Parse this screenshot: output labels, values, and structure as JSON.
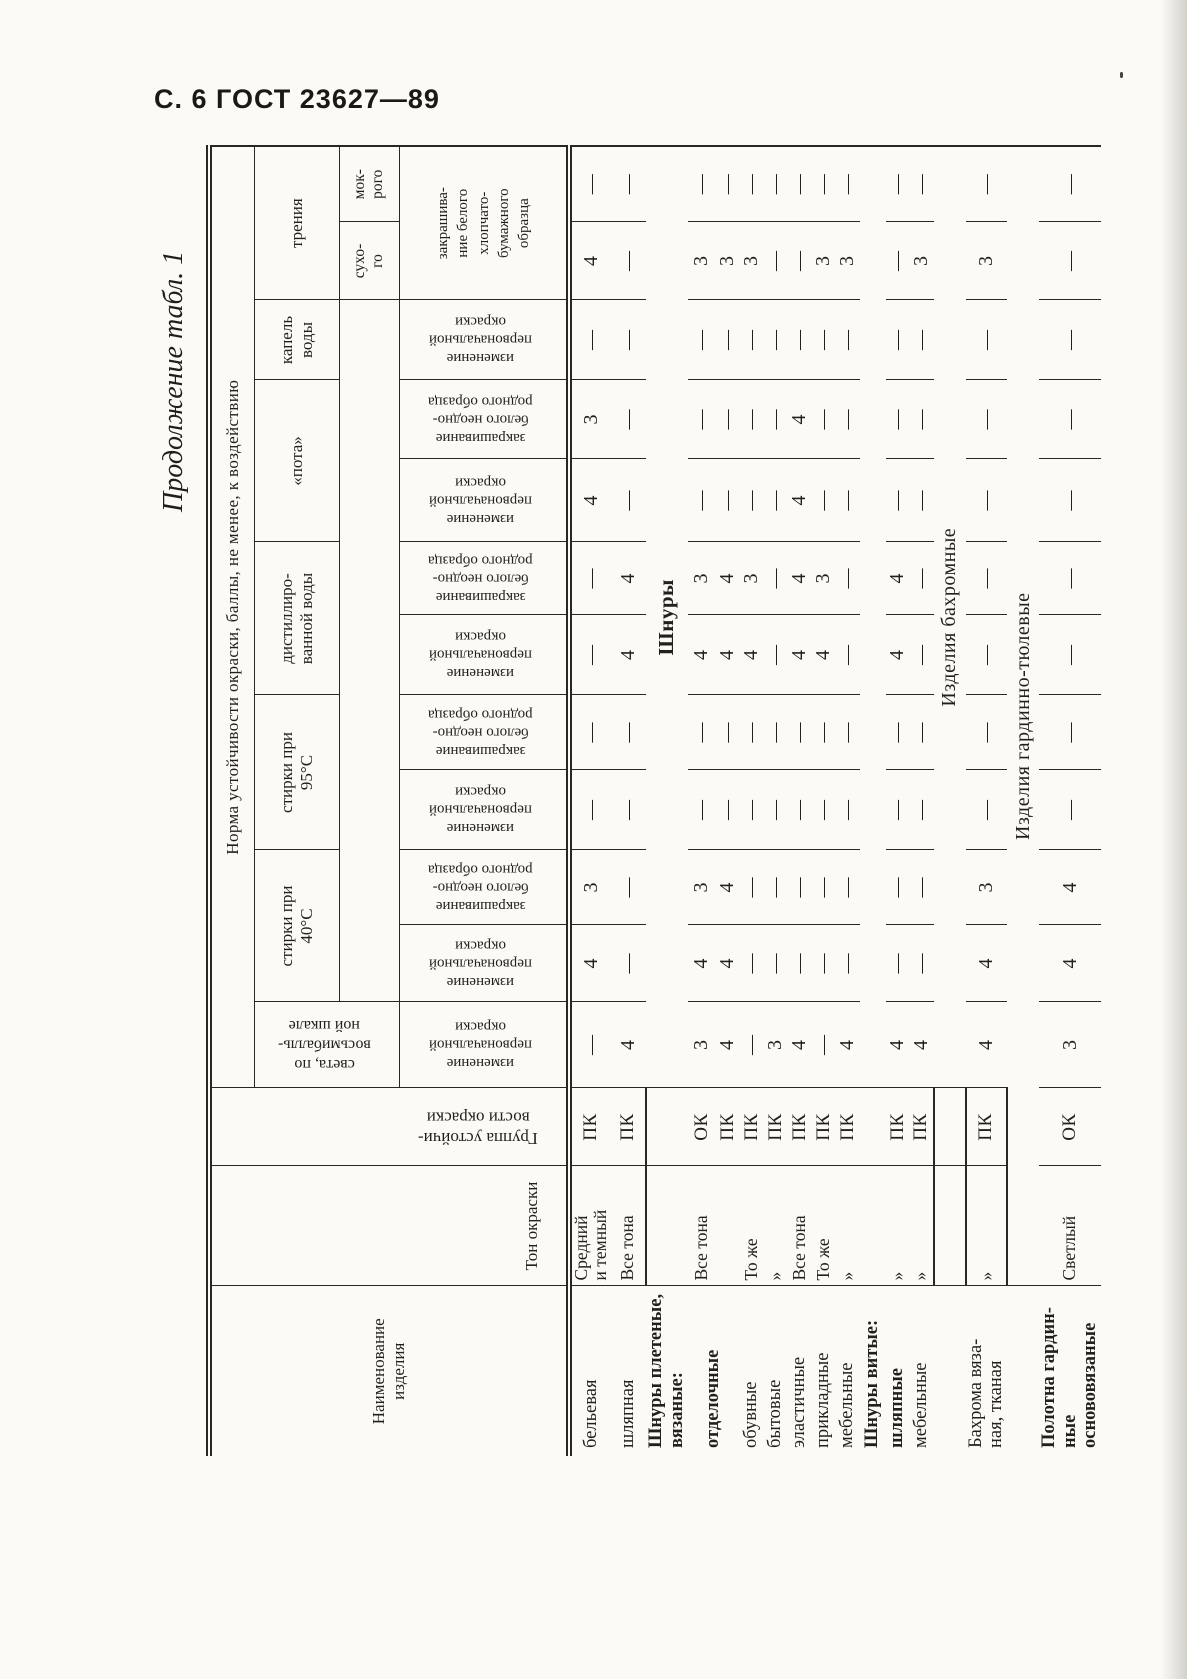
{
  "page": {
    "header": "С. 6 ГОСТ 23627—89",
    "continuation": "Продолжение табл. 1"
  },
  "colors": {
    "ink": "#241f19",
    "paper": "#fbfaf6",
    "rule": "#2b2620"
  },
  "table": {
    "header": {
      "name": "Наименование\nизделия",
      "tone": "Тон окраски",
      "group": "Группа устойчи-\nвости окраски",
      "norm": "Норма  устойчивости  окраски,  баллы,  не  менее,  к  воздействию",
      "scale5": "по пятибалльной шкале",
      "light": "света, по\nвосьмибалль-\nной шкале",
      "wash40": "стирки при\n40°С",
      "wash95": "стирки при\n95°С",
      "dist": "дистиллиро-\nванной воды",
      "sweat": "«пота»",
      "drops": "капель\nводы",
      "friction": "трения",
      "dry": "сухо-\nго",
      "wet": "мок-\nрого",
      "change": "изменение\nпервоначальной\nокраски",
      "stain": "закрашивание\nбелого неодно-\nродного образца",
      "stain_cotton": "закрашива-\nние белого\nхлопчато-\nбумажного\nобразца"
    },
    "value_columns": [
      "света — изменение первоначальной окраски",
      "стирки при 40°С — изменение",
      "стирки при 40°С — закрашивание",
      "стирки при 95°С — изменение",
      "стирки при 95°С — закрашивание",
      "дистиллированной воды — изменение",
      "дистиллированной воды — закрашивание",
      "«пота» — изменение",
      "«пота» — закрашивание",
      "капель воды — изменение",
      "трения сухого",
      "трения мокрого"
    ],
    "rows": [
      {
        "type": "product",
        "name": "бельевая",
        "ton": "Средний\nи темный",
        "grp": "ПК",
        "vals": [
          "—",
          "4",
          "3",
          "—",
          "—",
          "—",
          "—",
          "4",
          "3",
          "—",
          "4",
          "—"
        ],
        "sep_after": false
      },
      {
        "type": "product",
        "name": "шляпная",
        "ton": "Все тона",
        "grp": "ПК",
        "vals": [
          "4",
          "—",
          "—",
          "—",
          "—",
          "4",
          "4",
          "—",
          "—",
          "—",
          "—",
          "—"
        ],
        "sep_after": true
      },
      {
        "type": "section-span",
        "name": "Шнуры плетеные,\nвязаные:",
        "bold": true,
        "span": "Шнуры",
        "span_cols": "data",
        "sep_after": false
      },
      {
        "type": "product",
        "name": "отделочные",
        "bold": true,
        "name_rowspan": 2,
        "ton": "Все тона",
        "grp": "ОК",
        "vals": [
          "3",
          "4",
          "3",
          "—",
          "—",
          "4",
          "3",
          "—",
          "—",
          "—",
          "3",
          "—"
        ],
        "sep_after": false
      },
      {
        "type": "product",
        "name": null,
        "ton": "",
        "grp": "ПК",
        "vals": [
          "4",
          "4",
          "4",
          "—",
          "—",
          "4",
          "4",
          "—",
          "—",
          "—",
          "3",
          "—"
        ],
        "sep_after": false
      },
      {
        "type": "product",
        "name": "обувные",
        "ton": "То же",
        "grp": "ПК",
        "vals": [
          "—",
          "—",
          "—",
          "—",
          "—",
          "4",
          "3",
          "—",
          "—",
          "—",
          "3",
          "—"
        ],
        "sep_after": false
      },
      {
        "type": "product",
        "name": "бытовые",
        "ton": "»",
        "grp": "ПК",
        "vals": [
          "3",
          "—",
          "—",
          "—",
          "—",
          "—",
          "—",
          "—",
          "—",
          "—",
          "—",
          "—"
        ],
        "sep_after": false
      },
      {
        "type": "product",
        "name": "эластичные",
        "ton": "Все тона",
        "grp": "ПК",
        "vals": [
          "4",
          "—",
          "—",
          "—",
          "—",
          "4",
          "4",
          "4",
          "4",
          "—",
          "—",
          "—"
        ],
        "sep_after": false
      },
      {
        "type": "product",
        "name": "прикладные",
        "ton": "То же",
        "grp": "ПК",
        "vals": [
          "—",
          "—",
          "—",
          "—",
          "—",
          "4",
          "3",
          "—",
          "—",
          "—",
          "3",
          "—"
        ],
        "sep_after": false
      },
      {
        "type": "product",
        "name": "мебельные",
        "ton": "»",
        "grp": "ПК",
        "vals": [
          "4",
          "—",
          "—",
          "—",
          "—",
          "—",
          "—",
          "—",
          "—",
          "—",
          "3",
          "—"
        ],
        "sep_after": false
      },
      {
        "type": "section-name",
        "name": "Шнуры витые:",
        "bold": true,
        "sep_after": false
      },
      {
        "type": "product",
        "name": "шляпные",
        "bold": true,
        "ton": "»",
        "grp": "ПК",
        "vals": [
          "4",
          "—",
          "—",
          "—",
          "—",
          "4",
          "4",
          "—",
          "—",
          "—",
          "—",
          "—"
        ],
        "sep_after": false
      },
      {
        "type": "product",
        "name": "мебельные",
        "ton": "»",
        "grp": "ПК",
        "vals": [
          "4",
          "—",
          "—",
          "—",
          "—",
          "—",
          "—",
          "—",
          "—",
          "—",
          "3",
          "—"
        ],
        "sep_after": true
      },
      {
        "type": "section-span",
        "name": null,
        "span": "Изделия бахромные",
        "span_cols": "data",
        "sep_after": true
      },
      {
        "type": "product",
        "name": "Бахрома вяза-\nная, тканая",
        "ton": "»",
        "grp": "ПК",
        "vals": [
          "4",
          "4",
          "3",
          "—",
          "—",
          "—",
          "—",
          "—",
          "—",
          "—",
          "3",
          "—"
        ],
        "sep_after": true
      },
      {
        "type": "section-span",
        "name": null,
        "span": "Изделия гардинно-тюлевые",
        "span_cols": "wide",
        "sep_after": false
      },
      {
        "type": "product",
        "name": "Полотна гардин-\nные основовязаные",
        "bold": true,
        "ton": "Светлый",
        "grp": "ОК",
        "vals": [
          "3",
          "4",
          "4",
          "—",
          "—",
          "—",
          "—",
          "—",
          "—",
          "—",
          "—",
          "—"
        ],
        "sep_after": false
      }
    ]
  }
}
